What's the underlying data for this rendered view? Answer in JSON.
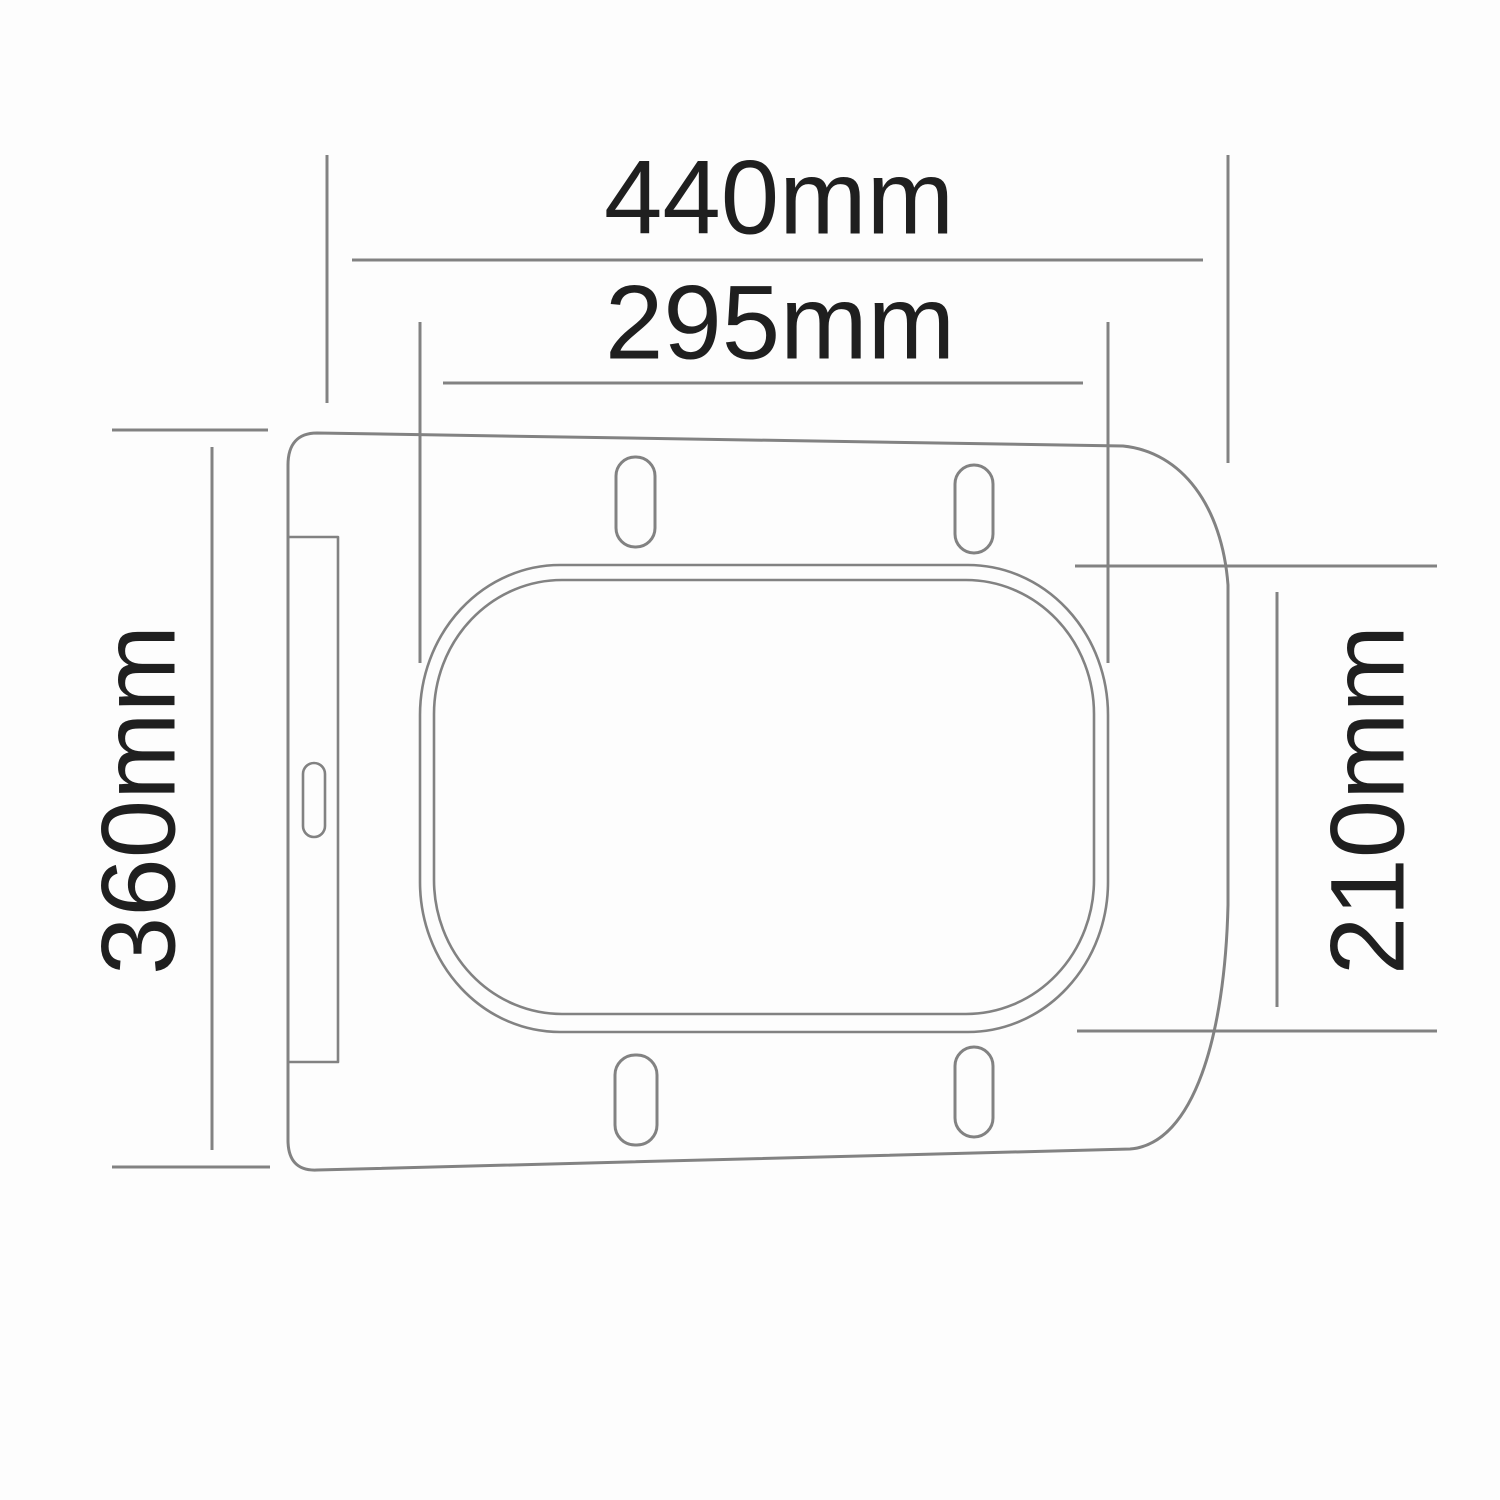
{
  "diagram": {
    "subject": "toilet-seat-top-view-dimension-drawing",
    "units": "mm",
    "dimensions": {
      "overall_width": {
        "label": "440mm",
        "value": 440,
        "orientation": "horizontal"
      },
      "inner_width": {
        "label": "295mm",
        "value": 295,
        "orientation": "horizontal"
      },
      "overall_depth": {
        "label": "360mm",
        "value": 360,
        "orientation": "vertical"
      },
      "inner_depth": {
        "label": "210mm",
        "value": 210,
        "orientation": "vertical"
      }
    },
    "features": {
      "top_slots": 2,
      "bottom_slots": 2,
      "hinge_plate_slots": 1
    },
    "colors": {
      "line": "#828282",
      "text": "#1f1f1f",
      "background": "#fdfdfd"
    }
  }
}
